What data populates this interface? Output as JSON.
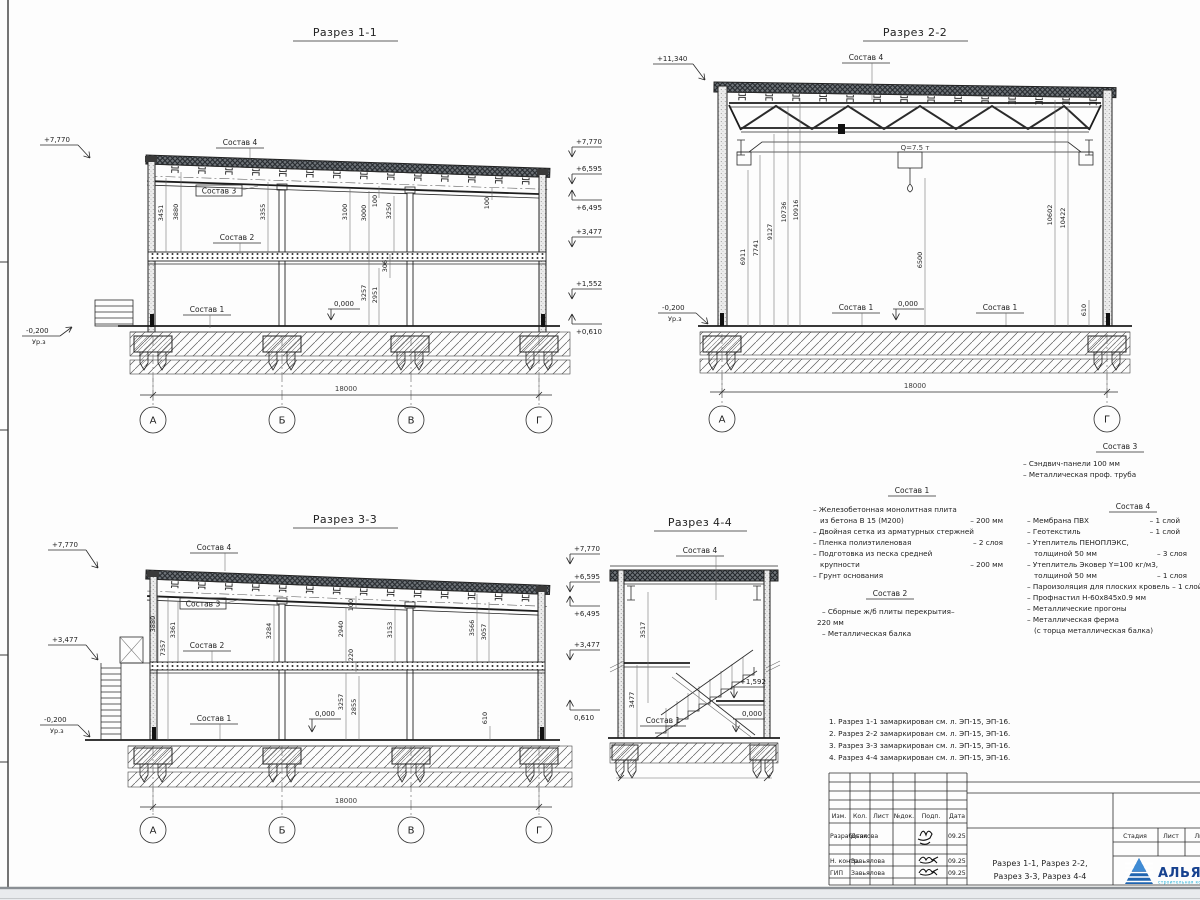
{
  "lbl": {
    "s1": "Состав 1",
    "s2": "Состав 2",
    "s3": "Состав 3",
    "s4": "Состав 4",
    "zero": "0,000",
    "urz": "Ур.з",
    "span": "18000"
  },
  "s11": {
    "title": "Разрез 1-1",
    "elevL": "+7,770",
    "elevBL": "-0,200",
    "elevsR": [
      "+7,770",
      "+6,595",
      "+6,495",
      "+3,477",
      "+1,552",
      "+0,610"
    ],
    "dims": [
      "3451",
      "3880",
      "3355",
      "3100",
      "3000",
      "100",
      "3250",
      "306",
      "3257",
      "2951",
      "100"
    ],
    "axes": [
      "А",
      "Б",
      "В",
      "Г"
    ]
  },
  "s22": {
    "title": "Разрез 2-2",
    "elevT": "+11,340",
    "elevBL": "-0,200",
    "crane": "Q=7.5 т",
    "dims": [
      "6911",
      "7741",
      "9127",
      "10736",
      "10916",
      "6500",
      "10602",
      "10422",
      "610"
    ],
    "axes": [
      "А",
      "Г"
    ]
  },
  "s33": {
    "title": "Разрез 3-3",
    "elevsL": [
      "+7,770",
      "+3,477"
    ],
    "elevBL": "-0,200",
    "elevsR": [
      "+7,770",
      "+6,595",
      "+6,495",
      "+3,477",
      "0,610"
    ],
    "dims": [
      "3880",
      "3361",
      "7357",
      "3284",
      "2940",
      "100",
      "220",
      "3153",
      "3566",
      "3057",
      "3257",
      "2855",
      "610"
    ],
    "axes": [
      "А",
      "Б",
      "В",
      "Г"
    ]
  },
  "s44": {
    "title": "Разрез 4-4",
    "dims": [
      "3517",
      "3477"
    ],
    "elevMid": "+1,592"
  },
  "comp1": {
    "title": "Состав 1",
    "l1": "– Железобетонная  монолитная плита",
    "l2": "из бетона В 15 (М200)",
    "v2": "– 200 мм",
    "l3": "– Двойная сетка из арматурных стержней",
    "l4": "– Пленка полиэтиленовая",
    "v4": "– 2 слоя",
    "l5": "– Подготовка из песка средней",
    "l6": "крупности",
    "v6": "– 200 мм",
    "l7": "– Грунт основания"
  },
  "comp2": {
    "title": "Состав 2",
    "l1": "– Сборные ж/б плиты перекрытия–",
    "l2": "220 мм",
    "l3": "– Металлическая балка"
  },
  "comp3": {
    "title": "Состав 3",
    "l1": "– Сэндвич-панели 100 мм",
    "l2": "– Металлическая проф. труба"
  },
  "comp4": {
    "title": "Состав 4",
    "l1": "– Мембрана ПВХ",
    "v1": "– 1 слой",
    "l2": "– Геотекстиль",
    "v2": "– 1 слой",
    "l3": "– Утеплитель ПЕНОПЛЭКС,",
    "l4": "толщиной 50 мм",
    "v4": "– 3 слоя",
    "l5": "– Утеплитель Эковер Y=100 кг/м3,",
    "l6": "толщиной 50 мм",
    "v6": "– 1 слоя",
    "l7": "– Пароизоляция для плоских кровель – 1 слой",
    "l8": "– Профнастил Н-60х845х0.9 мм",
    "l9": "– Металлические прогоны",
    "l10": "– Металлическая ферма",
    "l11": "(с торца металлическая балка)"
  },
  "notes": [
    "1. Разрез 1-1 замаркирован см. л. ЭП-15, ЭП-16.",
    "2. Разрез 2-2 замаркирован см. л. ЭП-15, ЭП-16.",
    "3. Разрез 3-3 замаркирован см. л. ЭП-15, ЭП-16.",
    "4. Разрез 4-4 замаркирован см. л. ЭП-15, ЭП-16."
  ],
  "tb": {
    "c1": "Изм.",
    "c2": "Кол.",
    "c3": "Лист",
    "c4": "№док.",
    "c5": "Подп.",
    "c6": "Дата",
    "r1role": "Разработал",
    "r1name": "Дьякова",
    "r1date": "09.25",
    "r2role": "Н. контр.",
    "r2name": "Завьялова",
    "r2date": "09.25",
    "r3role": "ГИП",
    "r3name": "Завьялова",
    "r3date": "09.25",
    "title1": "Разрез 1-1, Разрез 2-2,",
    "title2": "Разрез 3-3, Разрез 4-4",
    "stage": "Стадия",
    "sheet": "Лист",
    "sheets": "Листов",
    "logo": "АЛЬЯНС",
    "logoSub": "строительная компания"
  }
}
